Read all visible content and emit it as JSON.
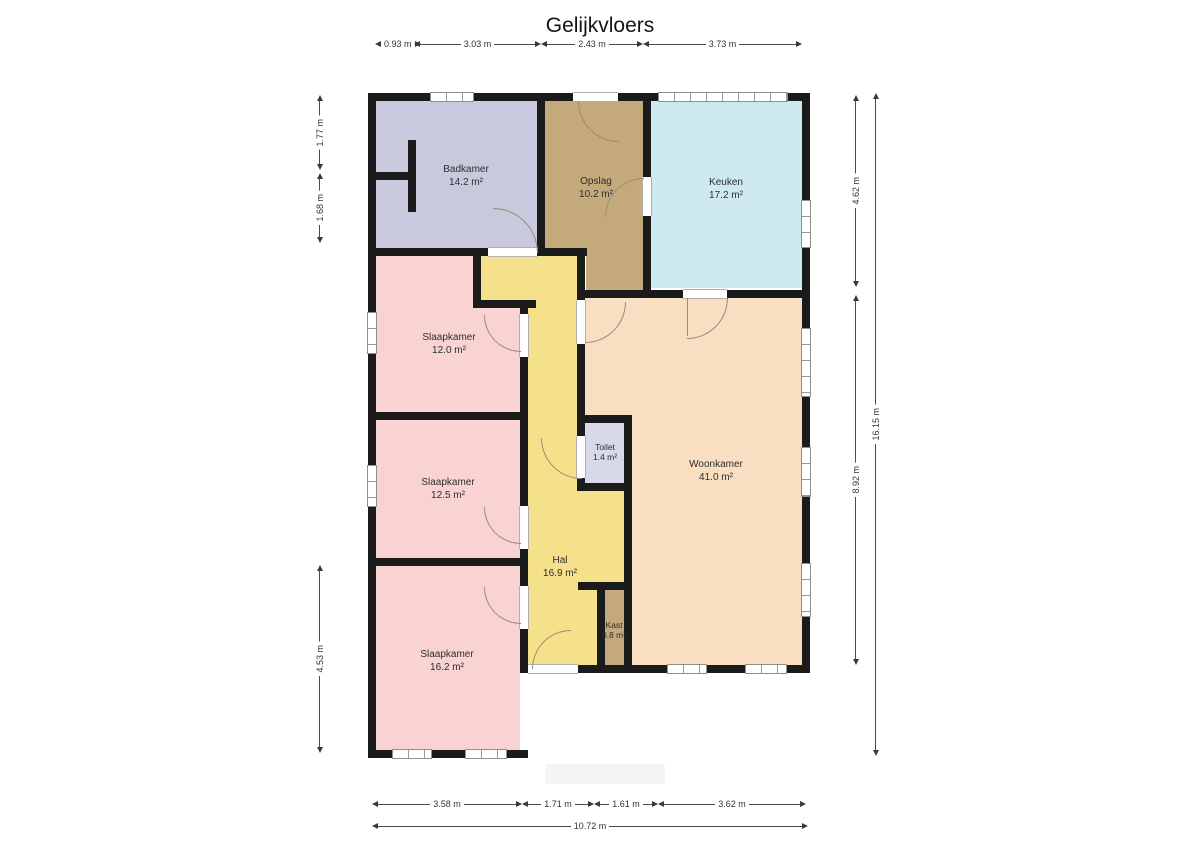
{
  "title": "Gelijkvloers",
  "floor_plan": {
    "wall_color": "#1b1b1b",
    "rooms": {
      "badkamer": {
        "name": "Badkamer",
        "area": "14.2 m²",
        "color": "#c8c9dc"
      },
      "opslag": {
        "name": "Opslag",
        "area": "10.2 m²",
        "color": "#c4a97a"
      },
      "keuken": {
        "name": "Keuken",
        "area": "17.2 m²",
        "color": "#cfe9f0"
      },
      "slaapkamer_1": {
        "name": "Slaapkamer",
        "area": "12.0 m²",
        "color": "#f8d3d1"
      },
      "slaapkamer_2": {
        "name": "Slaapkamer",
        "area": "12.5 m²",
        "color": "#f8d3d1"
      },
      "slaapkamer_3": {
        "name": "Slaapkamer",
        "area": "16.2 m²",
        "color": "#f8d3d1"
      },
      "hal": {
        "name": "Hal",
        "area": "16.9 m²",
        "color": "#f6e18b"
      },
      "toilet": {
        "name": "Toilet",
        "area": "1.4 m²",
        "color": "#d7d8e8"
      },
      "woonkamer": {
        "name": "Woonkamer",
        "area": "41.0 m²",
        "color": "#f9dec1"
      },
      "kast": {
        "name": "Kast",
        "area": "0.8 m²",
        "color": "#c4a97a"
      }
    },
    "dimensions": {
      "top": [
        "0.93 m",
        "3.03 m",
        "2.43 m",
        "3.73 m"
      ],
      "left": [
        "1.77 m",
        "1.68 m",
        "4.53 m"
      ],
      "right": [
        "4.62 m",
        "8.92 m"
      ],
      "right_total": "16.15 m",
      "bottom": [
        "3.58 m",
        "1.71 m",
        "1.61 m",
        "3.62 m"
      ],
      "bottom_total": "10.72 m"
    }
  }
}
